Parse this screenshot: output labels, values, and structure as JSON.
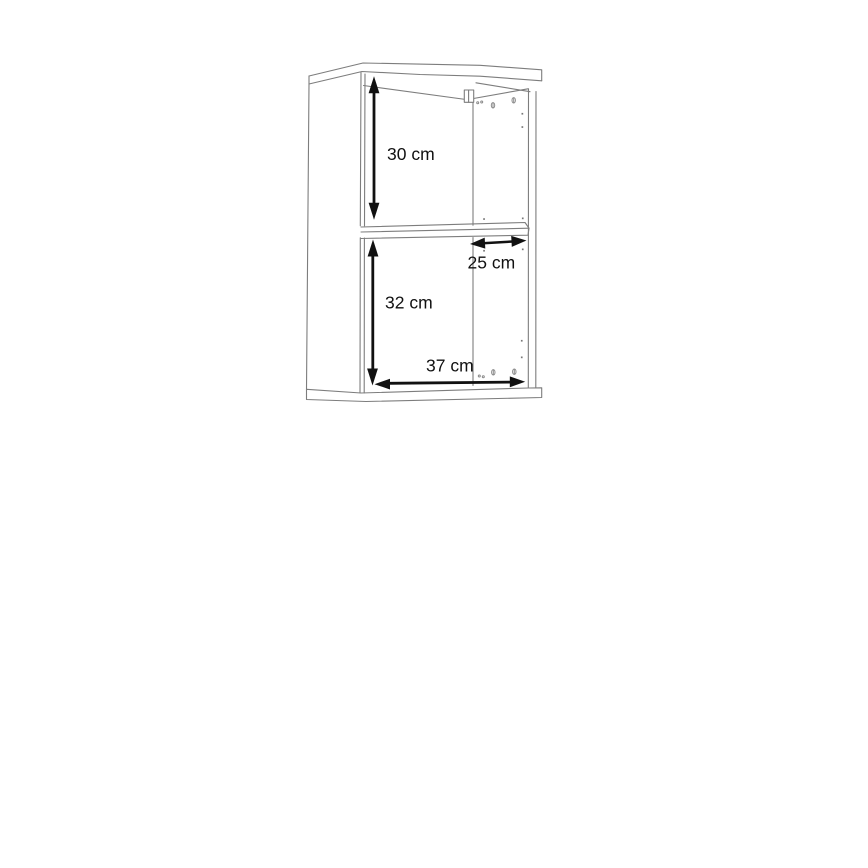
{
  "page": {
    "background": "#ffffff"
  },
  "diagram": {
    "type": "furniture-dimension-drawing",
    "subject": "wall cabinet with one middle shelf, open front, perspective line drawing",
    "line_color": "#7d7d7d",
    "arrow_color": "#111111",
    "dimensions": [
      {
        "id": "upper-compartment-height",
        "label": "30 cm",
        "orientation": "vertical"
      },
      {
        "id": "shelf-depth",
        "label": "25 cm",
        "orientation": "horizontal"
      },
      {
        "id": "lower-compartment-height",
        "label": "32 cm",
        "orientation": "vertical"
      },
      {
        "id": "interior-width",
        "label": "37 cm",
        "orientation": "horizontal"
      }
    ]
  }
}
